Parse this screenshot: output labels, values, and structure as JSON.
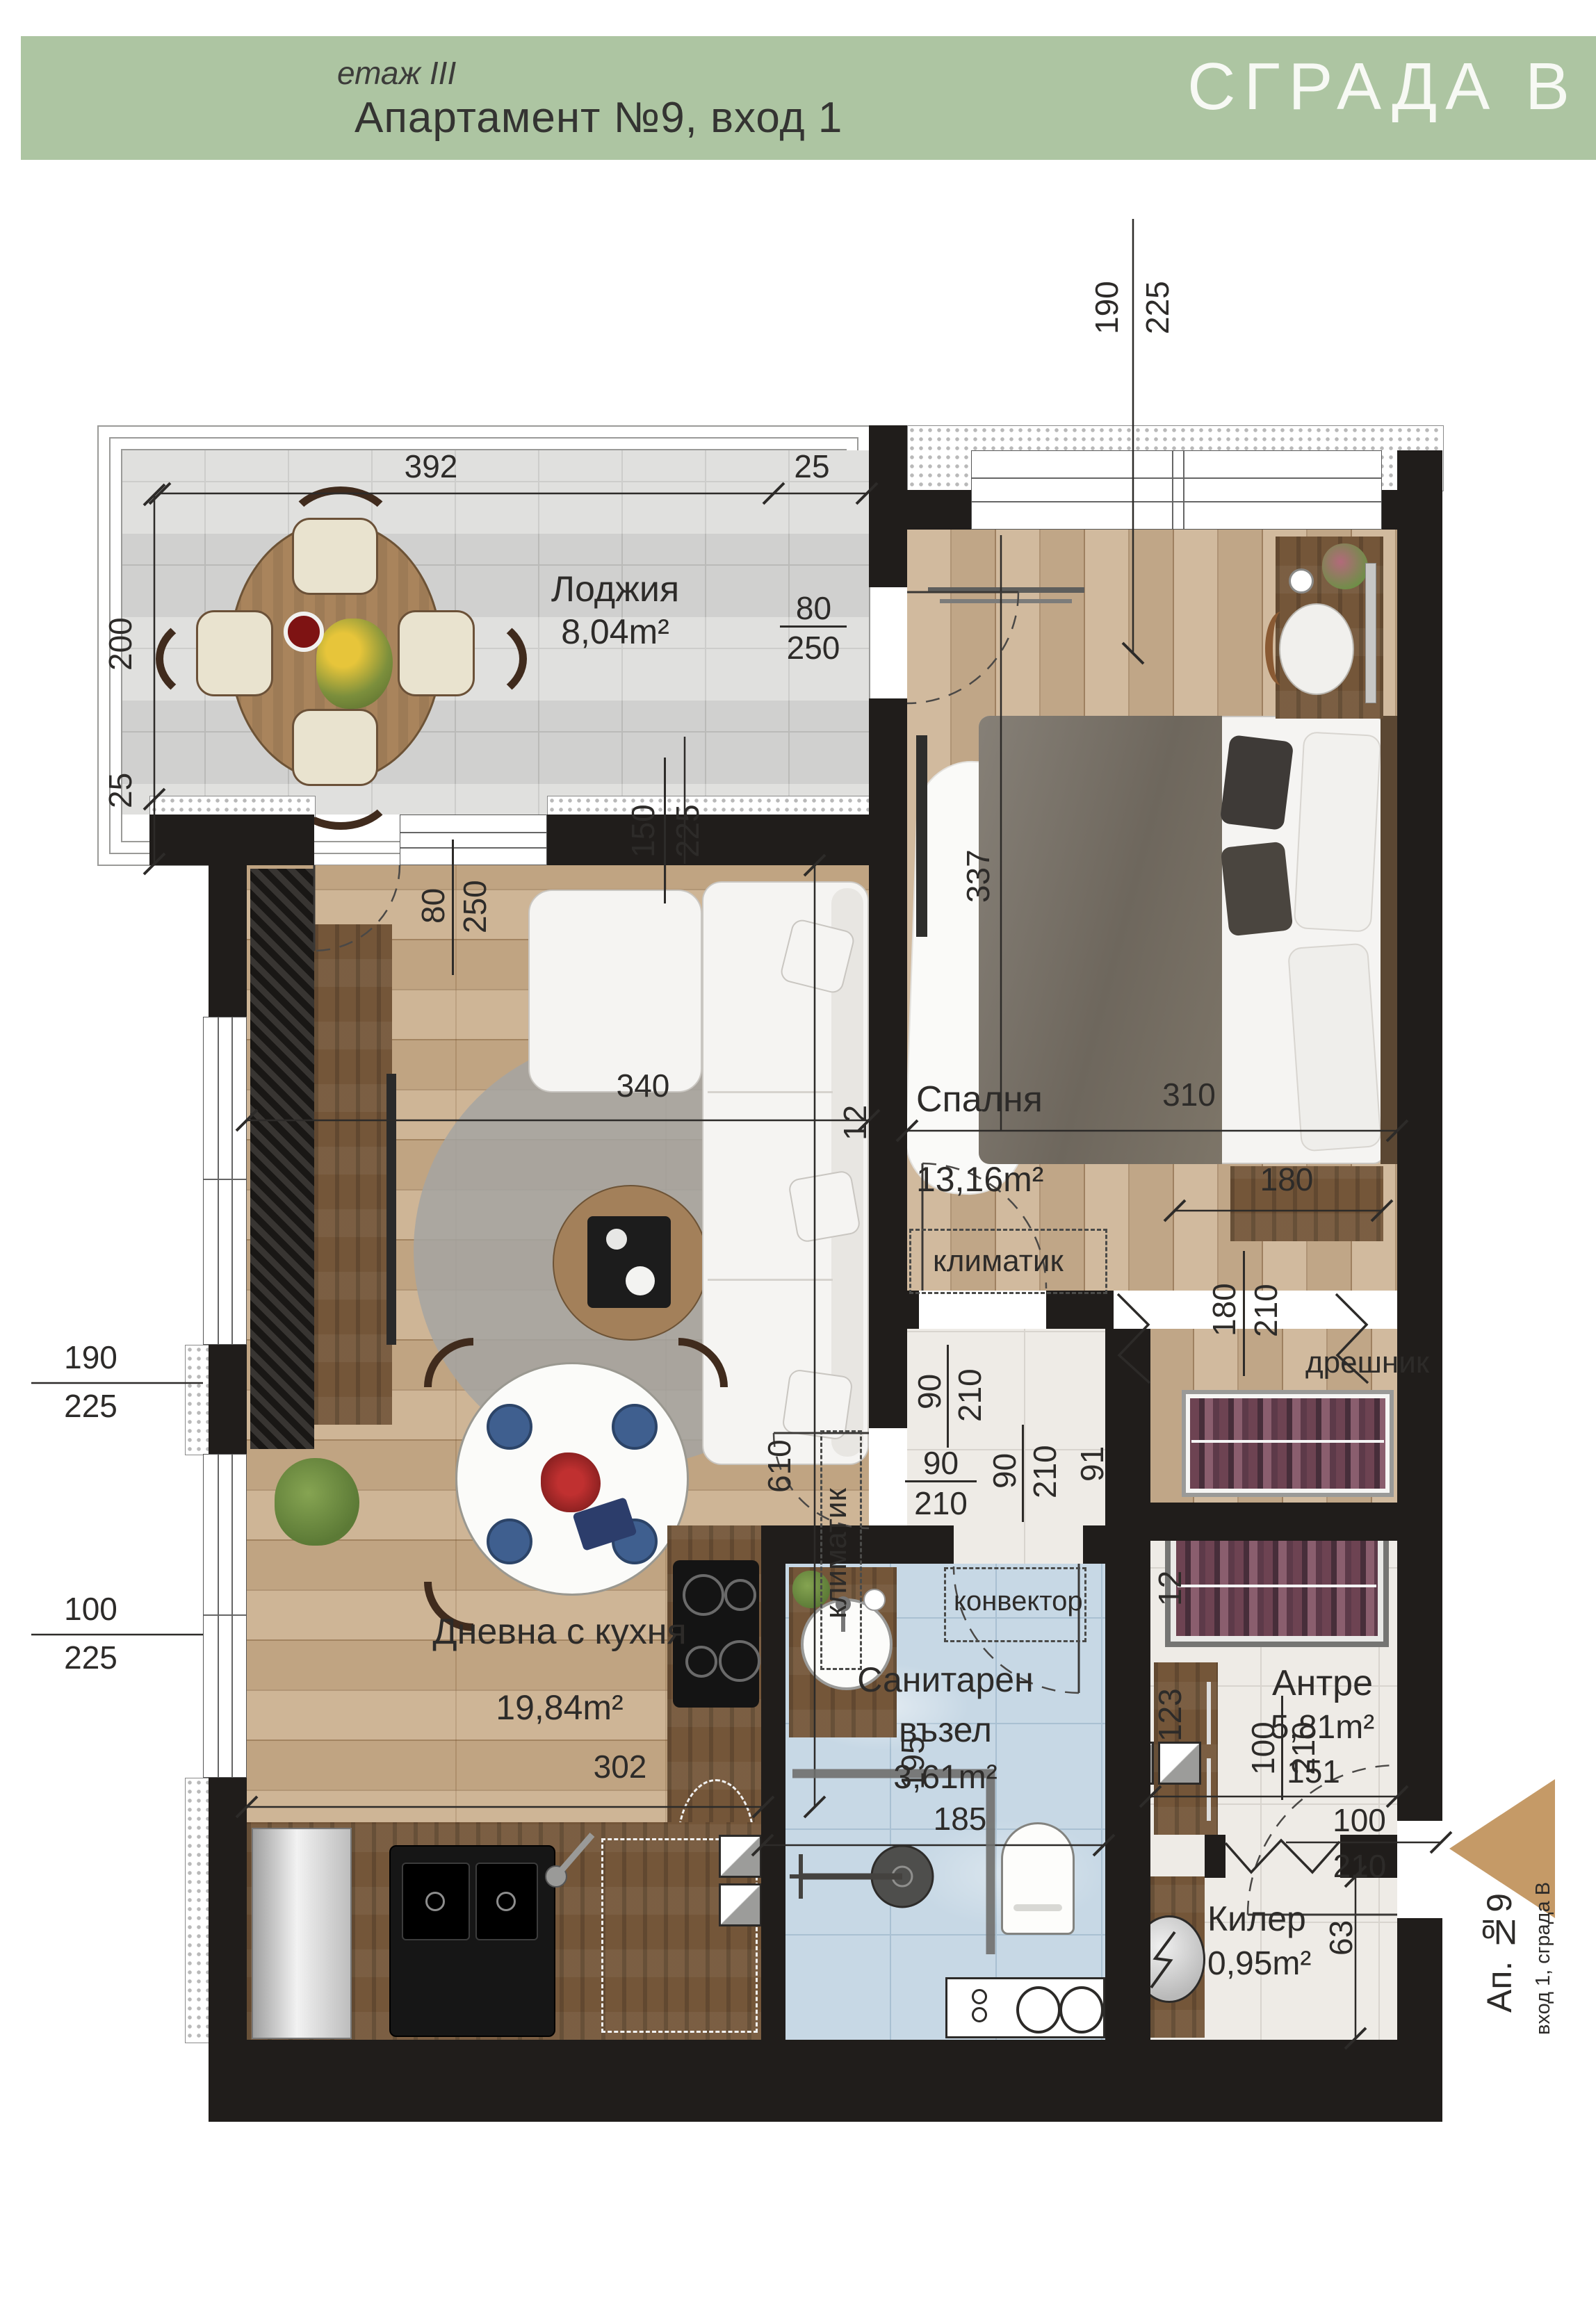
{
  "header": {
    "floor_label": "етаж III",
    "apartment_title": "Апартамент №9, вход 1",
    "building_label": "СГРАДА В"
  },
  "rooms": {
    "loggia": {
      "name": "Лоджия",
      "area": "8,04m²"
    },
    "bedroom": {
      "name": "Спалня",
      "area": "13,16m²"
    },
    "living": {
      "name": "Дневна с кухня",
      "area": "19,84m²"
    },
    "bathroom": {
      "name_line1": "Санитарен",
      "name_line2": "възел",
      "area": "3,61m²"
    },
    "entry_hall": {
      "name": "Антре",
      "area": "5,81m²"
    },
    "closet": {
      "name": "Килер",
      "area": "0,95m²"
    },
    "wardrobe": {
      "name": "дрешник"
    }
  },
  "labels": {
    "ac_bedroom": "климатик",
    "ac_living": "климатик",
    "convector": "конвектор",
    "entrance_apartment": "Ап. №9",
    "entrance_sub": "вход 1, сграда В"
  },
  "dims": {
    "loggia_width": "392",
    "loggia_width_ext": "25",
    "loggia_depth": "200",
    "loggia_depth_ext": "25",
    "door_loggia_bedroom": [
      "80",
      "250"
    ],
    "window_loggia_living": [
      "150",
      "225"
    ],
    "door_loggia_living": [
      "80",
      "250"
    ],
    "window_bedroom": [
      "190",
      "225"
    ],
    "bedroom_length": "337",
    "bedroom_width": "310",
    "wall_b": "12",
    "wardrobe_width": "180",
    "wardrobe_door": [
      "180",
      "210"
    ],
    "wardrobe_depth": "91",
    "living_width": "340",
    "wall_a": "12",
    "living_length": "610",
    "window_living_upper": [
      "190",
      "225"
    ],
    "window_living_lower": [
      "100",
      "225"
    ],
    "kitchen_width": "302",
    "door_bedroom": [
      "90",
      "210"
    ],
    "door_living": [
      "90",
      "210"
    ],
    "door_bathroom": [
      "90",
      "210"
    ],
    "shower_depth": "195",
    "bathroom_width": "185",
    "hall_width": "151",
    "hall_wall": "12",
    "hall_depth": "123",
    "door_entrance": [
      "100",
      "210"
    ],
    "door_closet": [
      "100",
      "210"
    ],
    "closet_depth": "63"
  },
  "colors": {
    "header_green": "#adc5a2",
    "wall": "#201d1b",
    "entrance_arrow": "#c59a67",
    "bath_tile": "#c7d8e5"
  }
}
